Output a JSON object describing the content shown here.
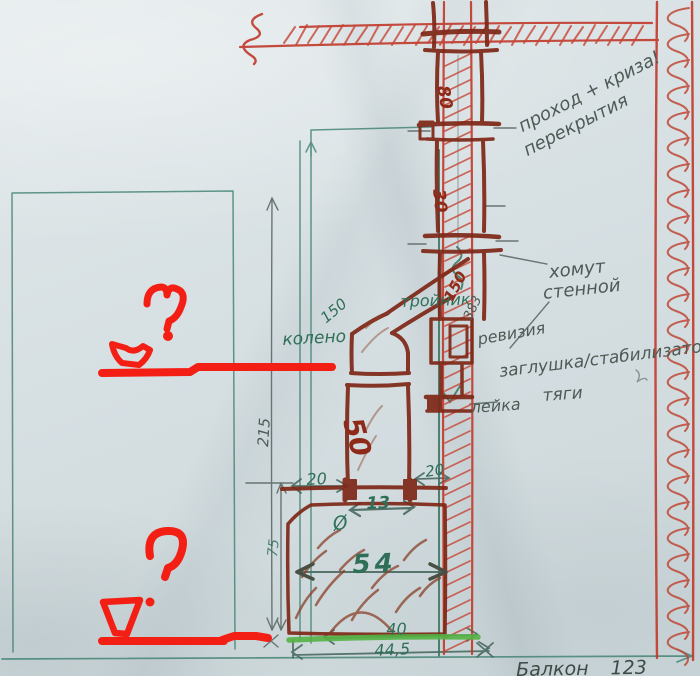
{
  "labels": {
    "passage_line1": "проход + криза!",
    "passage_line2": "перекрытия",
    "clamp_line1": "хомут",
    "clamp_line2": "стенной",
    "tee": "тройник",
    "revision": "ревизия",
    "plug_line1": "заглушка/стабилизатор",
    "plug_line2": "тяги",
    "funnel": "лейка",
    "elbow": "колено",
    "balcony": "Балкон 123"
  },
  "dimensions": {
    "total_height": "215",
    "stove_height": "75",
    "pipe_dia_80": "80",
    "pipe_len_30": "30",
    "pipe_dia_150_tee": "150",
    "pipe_len_383": "383",
    "pipe_dia_150_elbow": "150",
    "pipe_len_50": "50",
    "gap_left_20": "20",
    "gap_right_20": "20",
    "hole_width_13": "13",
    "diameter_symbol": "Ø",
    "stove_width_54": "54",
    "base_width_40": "40",
    "base_width_445": "44,5"
  },
  "colors": {
    "marker_red": "#c0392b",
    "pipe_brown": "#7e2817",
    "pencil_teal": "#3d8070",
    "pencil_graphite": "#55625e",
    "paint_red": "#f41f14",
    "highlight_green": "#54b244"
  }
}
